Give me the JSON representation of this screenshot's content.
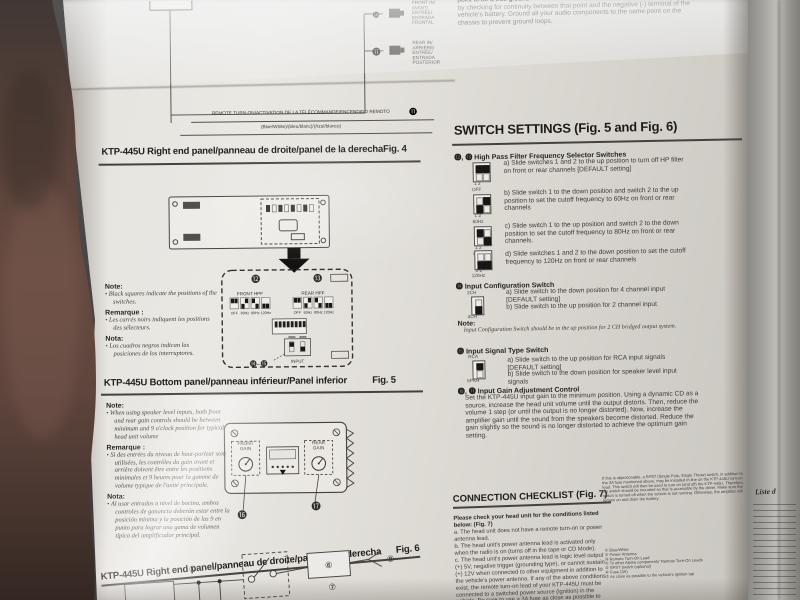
{
  "colors": {
    "paper": "#e4e2dd",
    "ink": "#2f2d2a",
    "hand": "#5d463d",
    "background": "#2c2b2a"
  },
  "left": {
    "wiring": {
      "front_in_callout": "❿",
      "front_in_label": "FRONT IN/\nAVANT/\nENTRÉE/\nENTRADA\nFRONTAL",
      "rear_in_callout": "⓫",
      "rear_in_label": "REAR IN/\nARRIÈRE/\nENTRÉE/\nENTRADA\nPOSTERIOR",
      "remote_label": "REMOTE TURN-ON/ACTIVATION DE LA TÉLÉCOMMANDE/ENCENDIDO REMOTO",
      "remote_callout": "⓫",
      "remote_wire_color": "(Blue/White)/(bleu/blanc)/(Azul/blanco)"
    },
    "fig4": {
      "title": "KTP-445U Right end panel/panneau de droite/panel de la derecha",
      "fig": "Fig. 4"
    },
    "detail": {
      "callout_12": "⓬",
      "callout_13": "⓭",
      "front_hpf": "FRONT HPF",
      "rear_hpf": "REAR HPF",
      "freq": [
        "OFF",
        "60Hz",
        "80Hz",
        "120Hz"
      ],
      "input": "INPUT",
      "callout_14_15": "⓮–⓯"
    },
    "note1": {
      "note_h": "Note:",
      "note": "• Black squares indicate the positions of the switches.",
      "rem_h": "Remarque :",
      "rem": "• Les carrés noirs indiquent les positions des sélecteurs.",
      "nota_h": "Nota:",
      "nota": "• Los cuadros negros indican las posiciones de los interruptores."
    },
    "fig5": {
      "title": "KTP-445U Bottom panel/panneau inférieur/Panel inferior",
      "fig": "Fig. 5"
    },
    "note2": {
      "note_h": "Note:",
      "note": "• When using speaker level inputs, both front and rear gain controls should be between minimum and 9 o'clock position for typical head unit volume",
      "rem_h": "Remarque :",
      "rem": "• Si des entrées du niveau de haut-parleur sont utilisées, les contrôles du gain avant et arrière doivent être entre les positions minimales et 9 heures pour la gamme de volume typique de l'unité principale.",
      "nota_h": "Nota:",
      "nota": "• Al usar entradas a nivel de bocina, ambos controles de ganancia deberán estar entre la posición mínima y la posición de las 9 en punto para lograr una gama de volumen típica del amplificador principal."
    },
    "fig5d": {
      "front_gain": "FRONT\nGAIN",
      "rear_gain": "REAR\nGAIN",
      "callout_16": "⓰",
      "callout_17": "⓱"
    },
    "fig6": {
      "title": "KTP-445U Right end panel/panneau de droite/panel de la derecha",
      "fig": "Fig. 6"
    },
    "circuit": {
      "c1": "①",
      "c6": "⑥",
      "c7": "⑦",
      "c8": "⑧"
    }
  },
  "right": {
    "top_paragraph": "point to be a true ground\nby checking for continuity between that point and the negative (-) terminal of the vehicle's battery. Ground all your audio components to the same point on the chassis to prevent ground loops.",
    "settings": {
      "heading": "SWITCH SETTINGS (Fig. 5 and Fig. 6)",
      "hpf_heading": "⓬, ⓭ High Pass Filter Frequency Selector Switches",
      "dip_nums": "1 2",
      "items": [
        {
          "freq": "OFF",
          "text": "a) Slide switches 1 and 2 to the up position to turn off HP filter on front or rear channels [DEFAULT setting]"
        },
        {
          "freq": "60Hz",
          "text": "b) Slide switch 1 to the down position and switch 2 to the up position to set the cutoff frequency to 60Hz on front or rear channels"
        },
        {
          "freq": "80Hz",
          "text": "c) Slide switch 1 to the up position and switch 2 to the down position to set the cutoff frequency to 80Hz on front or rear channels."
        },
        {
          "freq": "120Hz",
          "text": "d) Slide switches 1 and 2 to the down position to set the cutoff frequency to 120Hz on front or rear channels"
        }
      ],
      "cfg": {
        "heading": "⓮ Input Configuration Switch",
        "icon_top": "2CH",
        "icon_bottom": "4CH",
        "a": "a) Slide switch to the down position for 4 channel input [DEFAULT setting]",
        "b": "b) Slide switch to the up position for 2 channel input",
        "note_h": "Note:",
        "note": "Input Configuration Switch should be in the up position for 2 CH bridged output system."
      },
      "sig": {
        "heading": "⓯ Input Signal Type Switch",
        "icon_top": "RCA",
        "icon_bottom": "SPKR",
        "a": "a) Slide switch to the up position for RCA input signals [DEFAULT setting]",
        "b": "b) Slide switch to the down position for speaker level input signals"
      },
      "gain": {
        "heading": "⓰, ⓱ Input Gain Adjustment Control",
        "text": "Set the KTP-445U input gain to the minimum position. Using a dynamic CD as a source, increase the head unit volume until the output distorts. Then, reduce the volume 1 step (or until the output is no longer distorted). Now, increase the amplifier gain until the sound from the speakers become distorted. Reduce the gain slightly so the sound is no longer distorted to achieve the optimum gain setting."
      }
    },
    "checklist": {
      "heading": "CONNECTION CHECKLIST (Fig. 7)",
      "intro": "Please check your head unit for the conditions listed below: (Fig. 7)",
      "item_a": "a. The head unit does not have a remote turn-on or power antenna lead.",
      "item_b": "b. The head unit's power antenna lead is activated only when the radio is on (turns off in the tape or CD Mode).",
      "item_c": "c. The head unit's power antenna lead is logic level output (+) 5V, negative trigger (grounding type), or cannot sustain (+) 12V when connected to other equipment in addition to the vehicle's power antenna. If any of the above conditions exist, the remote turn-on lead of your KTP-445U must be connected to a switched power source (ignition) in the vehicle. Be sure to use a 3A fuse as close as possible to this ignition tap. Using this connection method, the KTP-",
      "right_para": "If this is objectionable, a SPST (Single Pole, Single Throw) switch, in addition to the 3A fuse mentioned above, may be installed in-line on the KTP-445U turn-on lead. This switch will then be used to turn on (and off) the KTP-445U. Therefore, the switch should be mounted so that is accessible by the driver. Make sure the switch is turned off when the vehicle is not running. Otherwise, the amplifier will remain on and drain the battery.",
      "legend": [
        "① Blue/White",
        "② Power Antenna",
        "③ Remote Turn-On Lead",
        "④ To other Alpine components' Remote Turn-On Leads",
        "⑤ SPST Switch (optional)",
        "⑥ Fuse (3A)",
        "⑦ As close as possible to the vehicle's ignition tap"
      ]
    }
  },
  "side": {
    "heading": "Liste d"
  }
}
